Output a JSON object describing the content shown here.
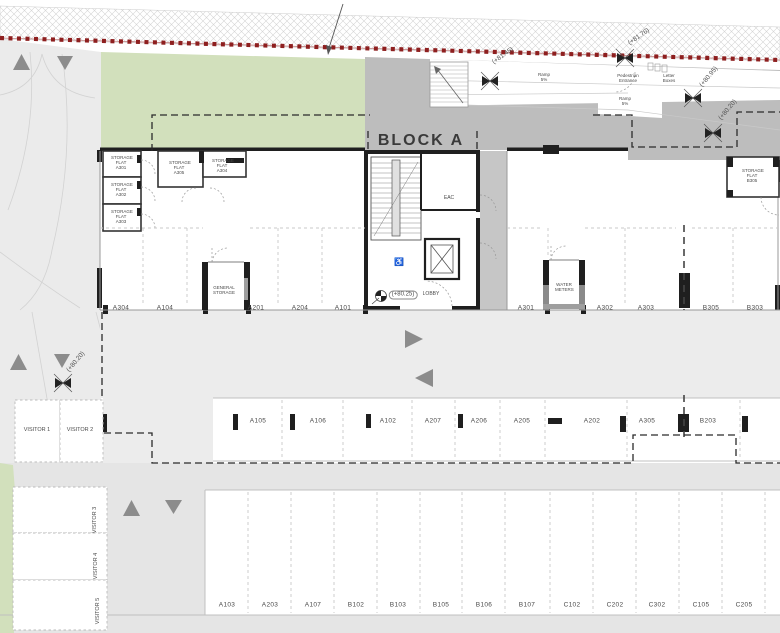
{
  "title": "BLOCK A",
  "icons": {
    "wheelchair": "♿"
  },
  "levels": {
    "lobby": "(+80.25)"
  },
  "elevation_markers": [
    "(+81.45)",
    "(+81.76)",
    "(+80.95)",
    "(+80.20)",
    "(+80.20)"
  ],
  "annotations": {
    "ramp_1": "Ramp 5%",
    "ramp_2": "Ramp 5%",
    "pedestrian_entrance": "Pedestrian Entrance",
    "letter_boxes": "Letter Boxes"
  },
  "rooms": {
    "eac": "EAC",
    "lobby": "LOBBY",
    "general_storage": "GENERAL STORAGE",
    "water_meters": "WATER METERS"
  },
  "storage_flats": [
    "STORAGE FLAT A301",
    "STORAGE FLAT A302",
    "STORAGE FLAT A303",
    "STORAGE FLAT A305",
    "STORAGE FLAT A304",
    "STORAGE FLAT B305"
  ],
  "parking_rows": {
    "top": [
      "A304",
      "A104",
      "A201",
      "A204",
      "A101",
      "A301",
      "A302",
      "A303",
      "B305",
      "B303"
    ],
    "middle": [
      "A105",
      "A106",
      "A102",
      "A207",
      "A206",
      "A205",
      "A202",
      "A305",
      "B203"
    ],
    "bottom": [
      "A103",
      "A203",
      "A107",
      "B102",
      "B103",
      "B105",
      "B106",
      "B107",
      "C102",
      "C202",
      "C302",
      "C105",
      "C205"
    ]
  },
  "visitor_spaces": [
    "VISITOR 1",
    "VISITOR 2",
    "VISITOR 3",
    "VISITOR 4",
    "VISITOR 5"
  ],
  "colors": {
    "boundary_red": "#8e1f1f",
    "landscape_green": "#d2e0bc",
    "paving_gray": "#bdbdbd",
    "aisle_gray": "#ececec",
    "wall_black": "#1f1f1f",
    "arrow_gray": "#8c8c8c"
  }
}
